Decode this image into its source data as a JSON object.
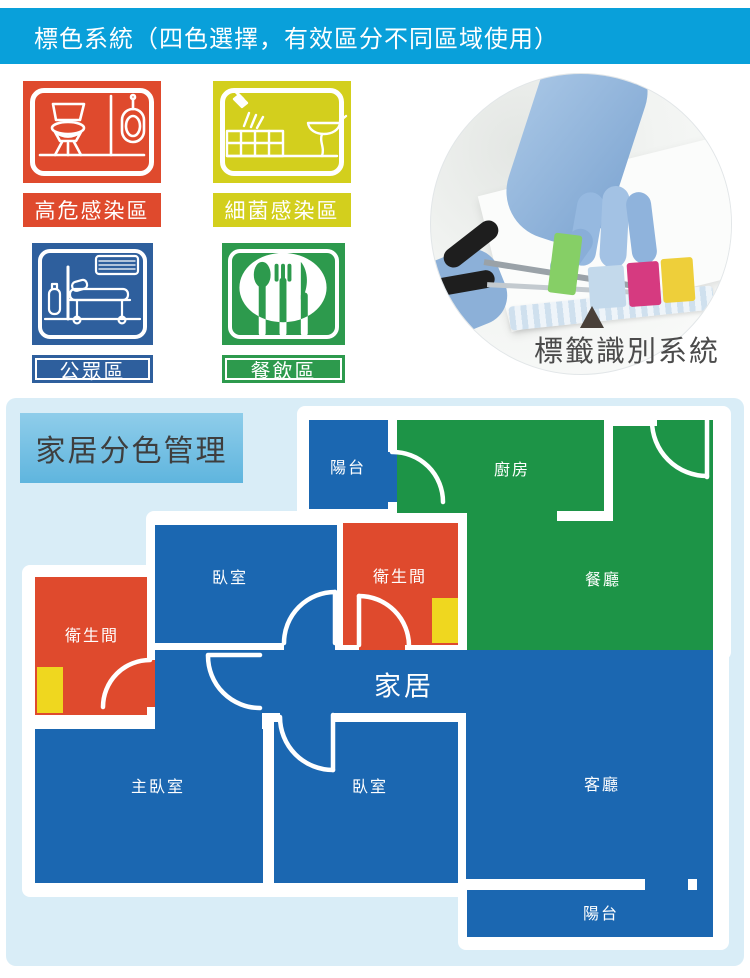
{
  "header": {
    "title": "標色系統（四色選擇，有效區分不同區域使用）"
  },
  "zones": [
    {
      "label": "高危感染區",
      "color": "#df4a2d",
      "icon": "toilet-urinal-icon"
    },
    {
      "label": "細菌感染區",
      "color": "#d3cf1d",
      "icon": "shower-bathtub-sink-icon"
    },
    {
      "label": "公眾區",
      "color": "#2e5f9d",
      "icon": "hospital-bed-icon"
    },
    {
      "label": "餐飲區",
      "color": "#2d9a4d",
      "icon": "cutlery-plate-icon"
    }
  ],
  "photo": {
    "caption": "標籤識別系統",
    "tab_colors": [
      "#86cf66",
      "#c3d9eb",
      "#d63a80",
      "#eecf3a"
    ],
    "glove_color": "#8cb0d8"
  },
  "floorplan": {
    "title": "家居分色管理",
    "center_label": "家居",
    "rooms": {
      "balcony_top": "陽台",
      "kitchen": "廚房",
      "dining": "餐廳",
      "bedroom_upper": "臥室",
      "bathroom_mid": "衛生間",
      "bathroom_left": "衛生間",
      "master_bedroom": "主臥室",
      "bedroom_lower": "臥室",
      "living": "客廳",
      "balcony_bottom": "陽台"
    },
    "colors": {
      "blue": "#1b67b1",
      "green": "#1d9447",
      "red": "#df4a2d",
      "yellow_patch": "#efd71f",
      "wall": "#ffffff",
      "section_background": "#d9edf7",
      "header_background": "#09a0da"
    }
  }
}
